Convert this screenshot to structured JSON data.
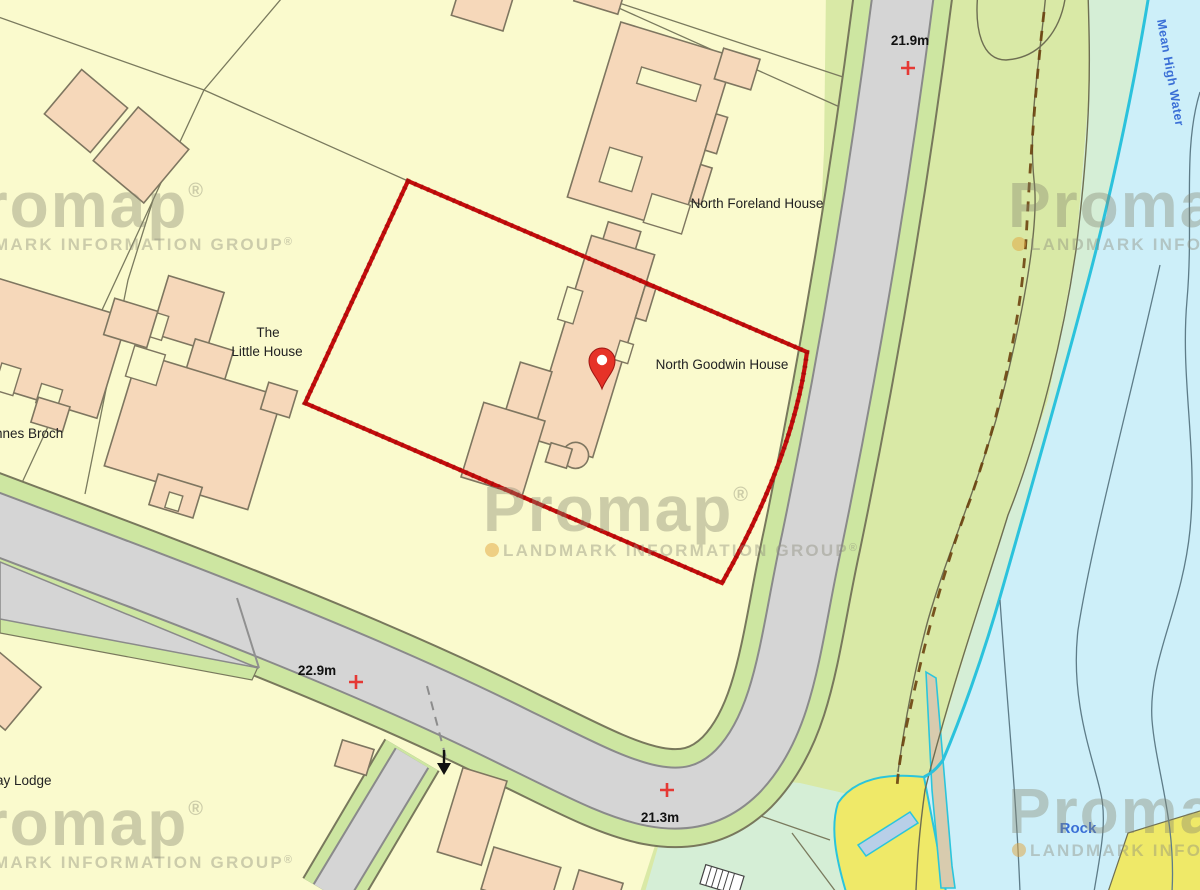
{
  "watermark": {
    "brand": "Promap",
    "reg": "®",
    "subtext": "LANDMARK INFORMATION GROUP",
    "sub_reg": "®"
  },
  "labels": {
    "north_foreland_house": "North Foreland House",
    "north_goodwin_house": "North Goodwin House",
    "the": "The",
    "little_house": "Little House",
    "innes_broch": "innes Broch",
    "ay_lodge": "ay Lodge"
  },
  "water_labels": {
    "mean_high_water": "Mean High Water",
    "rock": "Rock"
  },
  "spot_heights": {
    "north_road": "21.9m",
    "west_road": "22.9m",
    "south_road": "21.3m"
  },
  "icons": {
    "pin": "location-pin",
    "cross": "benchmark-cross",
    "arrow": "road-access-arrow"
  },
  "colors": {
    "land": "#fafacd",
    "building": "#f6d8ba",
    "building_outline": "#7e7660",
    "road": "#d5d5d5",
    "road_edge": "#8a8a8a",
    "verge_green": "#cde6a1",
    "coastal_green": "#d9e9a6",
    "mint_green": "#d5eed6",
    "water": "#cdeff9",
    "mean_high_water_line": "#2bc2dc",
    "beach_yellow": "#efe968",
    "boundary_red": "#c60c0c",
    "pin_red": "#e63228",
    "cross_red": "#e53935",
    "label_text": "#222222",
    "water_text": "#3a6fd6",
    "watermark_gray": "#84846e",
    "watermark_dot": "#e2a33c"
  }
}
